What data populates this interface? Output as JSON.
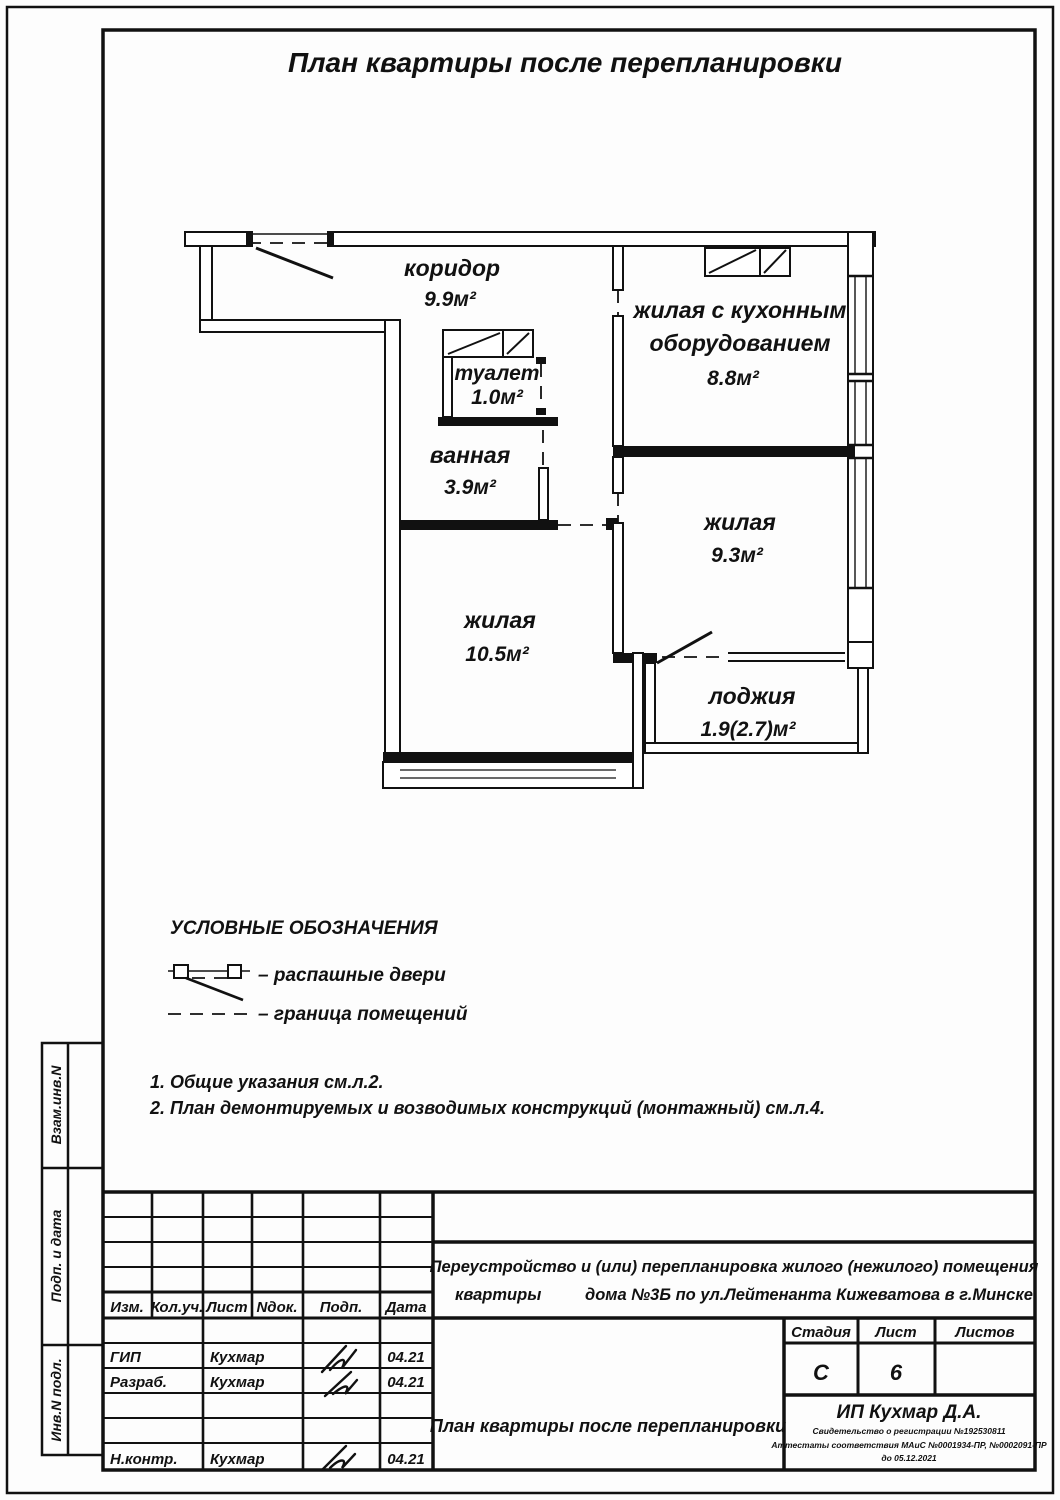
{
  "page_title": "План квартиры после перепланировки",
  "plan": {
    "rooms": {
      "corridor": {
        "name": "коридор",
        "area": "9.9м²"
      },
      "toilet": {
        "name": "туалет",
        "area": "1.0м²"
      },
      "bath": {
        "name": "ванная",
        "area": "3.9м²"
      },
      "kitchen_living": {
        "name_line1": "жилая с кухонным",
        "name_line2": "оборудованием",
        "area": "8.8м²"
      },
      "living_93": {
        "name": "жилая",
        "area": "9.3м²"
      },
      "living_105": {
        "name": "жилая",
        "area": "10.5м²"
      },
      "loggia": {
        "name": "лоджия",
        "area": "1.9(2.7)м²"
      }
    }
  },
  "legend": {
    "title": "УСЛОВНЫЕ ОБОЗНАЧЕНИЯ",
    "swing_doors_label": "– распашные двери",
    "room_boundary_label": "– граница помещений"
  },
  "notes": [
    "1. Общие указания см.л.2.",
    "2. План демонтируемых и возводимых конструкций (монтажный) см.л.4."
  ],
  "side_strip": {
    "labels": [
      "Взам.инв.N",
      "Подп. и дата",
      "Инв.N подл."
    ]
  },
  "title_block": {
    "rev_headers": [
      "Изм.",
      "Кол.уч.",
      "Лист",
      "Nдок.",
      "Подп.",
      "Дата"
    ],
    "roles": [
      {
        "role": "ГИП",
        "name": "Кухмар",
        "date": "04.21"
      },
      {
        "role": "Разраб.",
        "name": "Кухмар",
        "date": "04.21"
      },
      {
        "role": "Н.контр.",
        "name": "Кухмар",
        "date": "04.21"
      }
    ],
    "project_line1": "Переустройство и (или) перепланировка жилого (нежилого) помещения",
    "project_line2a": "квартиры",
    "project_line2b": "дома №3Б по ул.Лейтенанта Кижеватова в г.Минске",
    "stage_label": "Стадия",
    "sheet_label": "Лист",
    "sheets_label": "Листов",
    "stage_value": "С",
    "sheet_value": "6",
    "sheets_value": "",
    "drawing_name": "План квартиры после перепланировки",
    "org_name": "ИП Кухмар Д.А.",
    "org_line1": "Свидетельство о регистрации №192530811",
    "org_line2": "Аттестаты соответствия МАиС №0001934-ПР, №0002091-ПР",
    "org_line3": "до 05.12.2021"
  }
}
